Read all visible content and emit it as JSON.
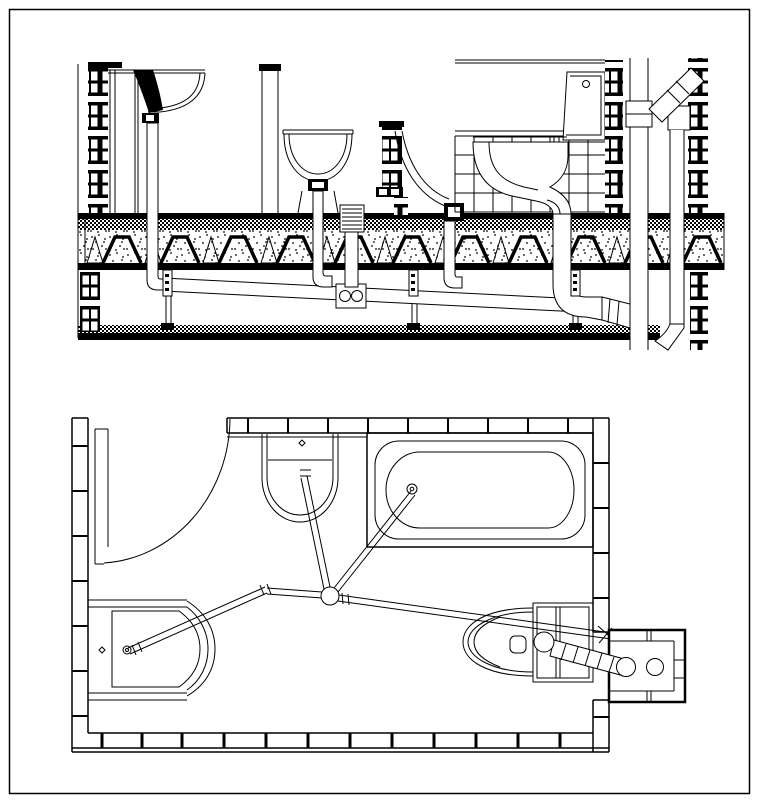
{
  "canvas": {
    "width": 762,
    "height": 808,
    "background": "#ffffff",
    "line_color": "#000000"
  },
  "drawing": {
    "kind": "cad-plumbing-detail",
    "text_labels": [],
    "views": {
      "section": {
        "name": "bathroom-plumbing-section",
        "components": [
          "brick-wall-left",
          "wall-hung-washbasin",
          "basin-trap-pipe",
          "pedestal-funnel-basin",
          "concealed-flush-unit",
          "flush-pipe-curve",
          "tiled-wall",
          "wc-pan",
          "cistern",
          "floor-drain-grate",
          "floor-slab-with-joists",
          "horizontal-drain-run",
          "double-socket-fitting",
          "ceiling-hangers",
          "suspended-ceiling",
          "soil-stack",
          "stack-reducer",
          "diagonal-vent-branch",
          "vent-pipe",
          "brick-wall-right-1",
          "brick-wall-right-2"
        ]
      },
      "plan": {
        "name": "bathroom-plumbing-plan",
        "components": [
          "door-swing-arc",
          "tiled-wall-top",
          "tiled-wall-left",
          "tiled-wall-right",
          "tiled-wall-bottom",
          "washbasin",
          "bathtub",
          "shower-basin",
          "wc-with-cistern",
          "central-floor-junction",
          "basin-drain-pipe",
          "tub-drain-pipe",
          "shower-drain-pipe",
          "main-drain-pipe",
          "wc-hatched-drain",
          "service-shaft",
          "stack-riser",
          "vent-riser"
        ]
      }
    }
  }
}
